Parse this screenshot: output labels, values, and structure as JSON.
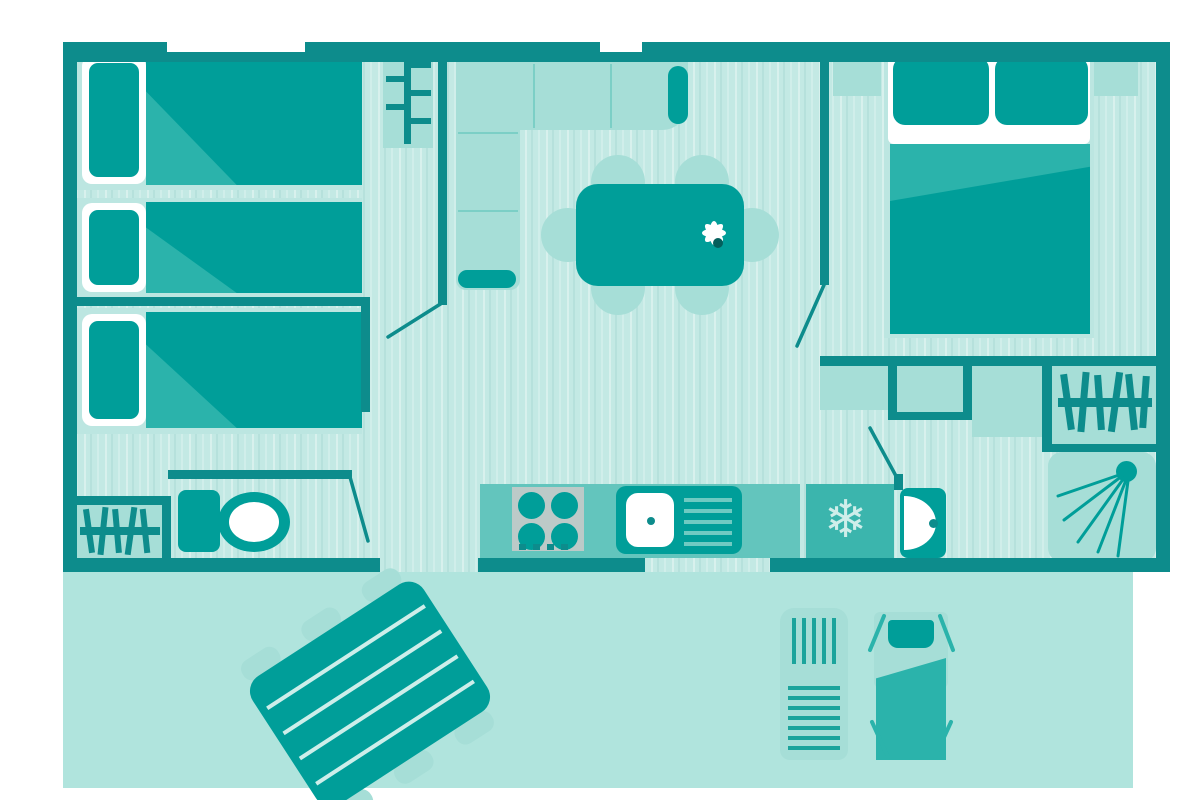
{
  "meta": {
    "kind": "floorplan-diagram",
    "subject": "mobile-home-layout-with-terrace",
    "visible_text": "none"
  },
  "colors": {
    "wall": "#0d8c8c",
    "furn-dark": "#009e99",
    "furn-mid": "#2bb3ab",
    "furn-light": "#a6ded7",
    "bed-base": "#bce6e1",
    "floor": "#c3e9e4",
    "terrace": "#b0e4dd",
    "counter": "#63c5bd",
    "fridge": "#3bb5ad",
    "stove-gray": "#bccac8",
    "white": "#ffffff"
  },
  "icons": {
    "snowflake_glyph": "❄",
    "snowflake_meaning": "fridge",
    "hanger_rail_meaning": "wardrobe",
    "shower_spray_meaning": "shower",
    "flower_meaning": "table-decoration"
  },
  "floorplan": {
    "rooms": [
      {
        "id": "bedroom-twin",
        "furniture": [
          "single-bed",
          "single-bed",
          "coat-rack"
        ]
      },
      {
        "id": "bedroom-single",
        "furniture": [
          "single-bed"
        ]
      },
      {
        "id": "living-kitchen",
        "furniture": [
          "corner-sofa",
          "dining-table",
          "six-chairs",
          "flower-decoration",
          "stove-4-burner",
          "sink-with-drainer",
          "fridge"
        ]
      },
      {
        "id": "bedroom-double",
        "furniture": [
          "double-bed",
          "nightstand-left",
          "nightstand-right"
        ]
      },
      {
        "id": "storage-nook",
        "furniture": [
          "cabinet",
          "cabinet",
          "cabinet"
        ]
      },
      {
        "id": "wardrobe-right",
        "furniture": [
          "hanging-rail"
        ]
      },
      {
        "id": "shower-room",
        "furniture": [
          "shower-tray",
          "washbasin"
        ]
      },
      {
        "id": "wc",
        "furniture": [
          "toilet"
        ]
      },
      {
        "id": "wardrobe-left",
        "furniture": [
          "hanging-rail"
        ]
      },
      {
        "id": "terrace",
        "furniture": [
          "picnic-table",
          "sun-lounger",
          "deck-chair"
        ]
      }
    ],
    "counts": {
      "single_beds": 3,
      "double_beds": 1,
      "dining_chairs": 6,
      "doors_with_swing": 4,
      "windows_top_wall": 2,
      "terrace_openings": 2
    },
    "layout_hints": {
      "orientation": "top-down plan",
      "terrace_position": "bottom",
      "double_bedroom": "right",
      "twin_bedrooms": "left"
    }
  }
}
